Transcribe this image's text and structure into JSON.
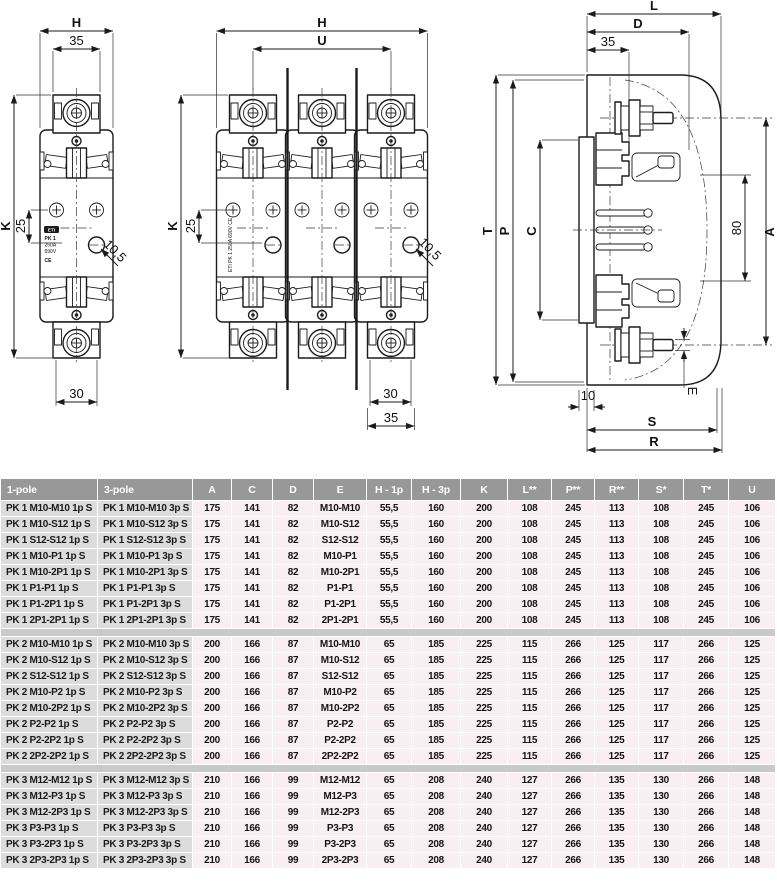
{
  "colors": {
    "header_bg": "#989898",
    "label_bg": "#dcdcdc",
    "value_bg": "#f9eff2",
    "separator_bg": "#c9c9c9",
    "line": "#1b1b1b"
  },
  "drawings": {
    "front_1pole": {
      "dim_h": "H",
      "dim_35": "35",
      "dim_k": "K",
      "dim_25": "25",
      "dim_30": "30",
      "dim_hole": "10,5",
      "marking": [
        "ETI",
        "PK 1",
        "250A",
        "690V",
        "CE"
      ]
    },
    "front_3pole": {
      "dim_h": "H",
      "dim_u": "U",
      "dim_k": "K",
      "dim_25": "25",
      "dim_30": "30",
      "dim_35": "35",
      "dim_hole": "10,5",
      "marking": "ETI PK 1 250A 690V CE"
    },
    "side_view": {
      "dim_l": "L",
      "dim_d": "D",
      "dim_35": "35",
      "dim_t": "T",
      "dim_p": "P",
      "dim_c": "C",
      "dim_a": "A",
      "dim_80": "80",
      "dim_10": "10",
      "dim_s": "S",
      "dim_r": "R",
      "dim_e": "E"
    }
  },
  "table": {
    "headers": [
      "1-pole",
      "3-pole",
      "A",
      "C",
      "D",
      "E",
      "H - 1p",
      "H - 3p",
      "K",
      "L**",
      "P**",
      "R**",
      "S*",
      "T*",
      "U"
    ],
    "groups": [
      {
        "rows": [
          [
            "PK 1 M10-M10 1p S",
            "PK 1 M10-M10 3p S",
            "175",
            "141",
            "82",
            "M10-M10",
            "55,5",
            "160",
            "200",
            "108",
            "245",
            "113",
            "108",
            "245",
            "106"
          ],
          [
            "PK 1 M10-S12 1p S",
            "PK 1 M10-S12 3p S",
            "175",
            "141",
            "82",
            "M10-S12",
            "55,5",
            "160",
            "200",
            "108",
            "245",
            "113",
            "108",
            "245",
            "106"
          ],
          [
            "PK 1 S12-S12 1p S",
            "PK 1 S12-S12 3p S",
            "175",
            "141",
            "82",
            "S12-S12",
            "55,5",
            "160",
            "200",
            "108",
            "245",
            "113",
            "108",
            "245",
            "106"
          ],
          [
            "PK 1 M10-P1 1p S",
            "PK 1 M10-P1 3p S",
            "175",
            "141",
            "82",
            "M10-P1",
            "55,5",
            "160",
            "200",
            "108",
            "245",
            "113",
            "108",
            "245",
            "106"
          ],
          [
            "PK 1 M10-2P1 1p S",
            "PK 1 M10-2P1 3p S",
            "175",
            "141",
            "82",
            "M10-2P1",
            "55,5",
            "160",
            "200",
            "108",
            "245",
            "113",
            "108",
            "245",
            "106"
          ],
          [
            "PK 1 P1-P1 1p S",
            "PK 1 P1-P1 3p S",
            "175",
            "141",
            "82",
            "P1-P1",
            "55,5",
            "160",
            "200",
            "108",
            "245",
            "113",
            "108",
            "245",
            "106"
          ],
          [
            "PK 1 P1-2P1 1p S",
            "PK 1 P1-2P1 3p S",
            "175",
            "141",
            "82",
            "P1-2P1",
            "55,5",
            "160",
            "200",
            "108",
            "245",
            "113",
            "108",
            "245",
            "106"
          ],
          [
            "PK 1 2P1-2P1 1p S",
            "PK 1 2P1-2P1 3p S",
            "175",
            "141",
            "82",
            "2P1-2P1",
            "55,5",
            "160",
            "200",
            "108",
            "245",
            "113",
            "108",
            "245",
            "106"
          ]
        ]
      },
      {
        "rows": [
          [
            "PK 2 M10-M10 1p S",
            "PK 2 M10-M10 3p S",
            "200",
            "166",
            "87",
            "M10-M10",
            "65",
            "185",
            "225",
            "115",
            "266",
            "125",
            "117",
            "266",
            "125"
          ],
          [
            "PK 2 M10-S12 1p S",
            "PK 2 M10-S12 3p S",
            "200",
            "166",
            "87",
            "M10-S12",
            "65",
            "185",
            "225",
            "115",
            "266",
            "125",
            "117",
            "266",
            "125"
          ],
          [
            "PK 2 S12-S12 1p S",
            "PK 2 S12-S12 3p S",
            "200",
            "166",
            "87",
            "S12-S12",
            "65",
            "185",
            "225",
            "115",
            "266",
            "125",
            "117",
            "266",
            "125"
          ],
          [
            "PK 2 M10-P2 1p S",
            "PK 2 M10-P2 3p S",
            "200",
            "166",
            "87",
            "M10-P2",
            "65",
            "185",
            "225",
            "115",
            "266",
            "125",
            "117",
            "266",
            "125"
          ],
          [
            "PK 2 M10-2P2 1p S",
            "PK 2 M10-2P2 3p S",
            "200",
            "166",
            "87",
            "M10-2P2",
            "65",
            "185",
            "225",
            "115",
            "266",
            "125",
            "117",
            "266",
            "125"
          ],
          [
            "PK 2 P2-P2 1p S",
            "PK 2 P2-P2 3p S",
            "200",
            "166",
            "87",
            "P2-P2",
            "65",
            "185",
            "225",
            "115",
            "266",
            "125",
            "117",
            "266",
            "125"
          ],
          [
            "PK 2 P2-2P2 1p S",
            "PK 2 P2-2P2 3p S",
            "200",
            "166",
            "87",
            "P2-2P2",
            "65",
            "185",
            "225",
            "115",
            "266",
            "125",
            "117",
            "266",
            "125"
          ],
          [
            "PK 2 2P2-2P2 1p S",
            "PK 2 2P2-2P2 3p S",
            "200",
            "166",
            "87",
            "2P2-2P2",
            "65",
            "185",
            "225",
            "115",
            "266",
            "125",
            "117",
            "266",
            "125"
          ]
        ]
      },
      {
        "rows": [
          [
            "PK 3 M12-M12 1p S",
            "PK 3 M12-M12 3p S",
            "210",
            "166",
            "99",
            "M12-M12",
            "65",
            "208",
            "240",
            "127",
            "266",
            "135",
            "130",
            "266",
            "148"
          ],
          [
            "PK 3 M12-P3 1p S",
            "PK 3 M12-P3 3p S",
            "210",
            "166",
            "99",
            "M12-P3",
            "65",
            "208",
            "240",
            "127",
            "266",
            "135",
            "130",
            "266",
            "148"
          ],
          [
            "PK 3 M12-2P3 1p S",
            "PK 3 M12-2P3 3p S",
            "210",
            "166",
            "99",
            "M12-2P3",
            "65",
            "208",
            "240",
            "127",
            "266",
            "135",
            "130",
            "266",
            "148"
          ],
          [
            "PK 3 P3-P3 1p S",
            "PK 3 P3-P3 3p S",
            "210",
            "166",
            "99",
            "P3-P3",
            "65",
            "208",
            "240",
            "127",
            "266",
            "135",
            "130",
            "266",
            "148"
          ],
          [
            "PK 3 P3-2P3 1p S",
            "PK 3 P3-2P3 3p S",
            "210",
            "166",
            "99",
            "P3-2P3",
            "65",
            "208",
            "240",
            "127",
            "266",
            "135",
            "130",
            "266",
            "148"
          ],
          [
            "PK 3 2P3-2P3 1p S",
            "PK 3 2P3-2P3 3p S",
            "210",
            "166",
            "99",
            "2P3-2P3",
            "65",
            "208",
            "240",
            "127",
            "266",
            "135",
            "130",
            "266",
            "148"
          ]
        ]
      }
    ]
  }
}
